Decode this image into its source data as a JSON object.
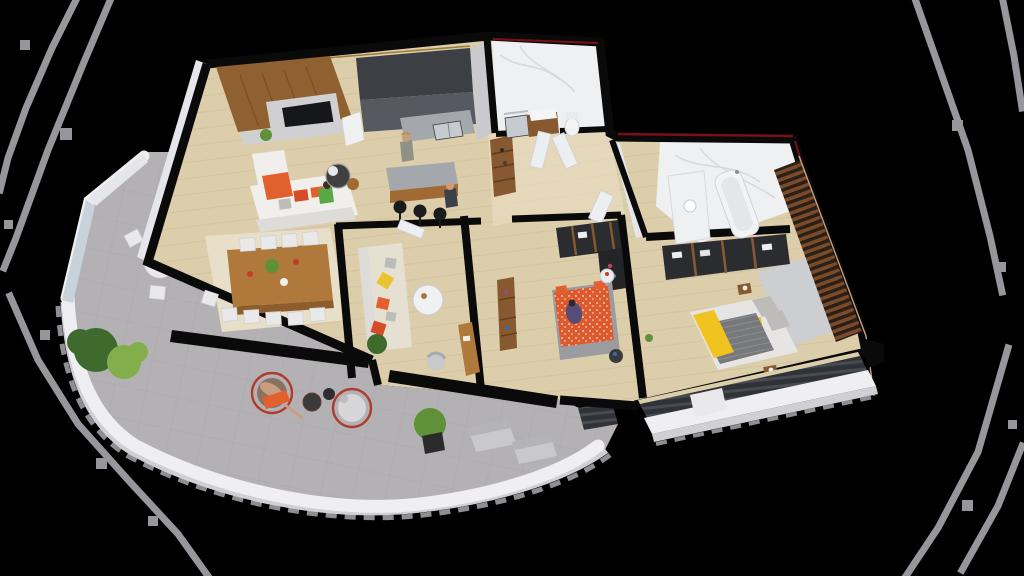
{
  "scene": {
    "type": "isometric-3d-apartment-floor-plan-render",
    "rooms": [
      "living-room",
      "kitchen",
      "dining-area",
      "lounge",
      "hallway",
      "bathroom",
      "bedroom",
      "master-bedroom",
      "ensuite-bathroom",
      "terrace",
      "west-balcony",
      "master-balcony"
    ]
  },
  "palette": {
    "background": "#000000",
    "decor-line": "#97979b",
    "jag-gray": "#8f8f93",
    "wall-top": "#0a0a0b",
    "wall-face": "#e5e6e9",
    "wood-floor": "#dccdab",
    "wood-line": "#ccb992",
    "wood-light": "#e7dcc0",
    "marble": "#eef0f2",
    "marble-vein": "#d5d9dd",
    "concrete": "#b3b1b4",
    "tile-line": "#a3a1a4",
    "parapet": "#efeff1",
    "parapet-side": "#cfcfd4",
    "glass": "#c8d2da",
    "tv-wood": "#8f6130",
    "tv-screen": "#15171b",
    "tv-marble": "#d0d0d3",
    "kitchen-dark": "#3c3f44",
    "kitchen-mid": "#565a60",
    "counter": "#a4a8ad",
    "sink": "#c7cbcf",
    "island-wood": "#a26a33",
    "stool-black": "#1a1b1d",
    "table-wood": "#b0793c",
    "table-side": "#8d5e2b",
    "chair-white": "#e9e9ea",
    "rug": "#e8dfc9",
    "rug-gray": "#cdced1",
    "sofa-white": "#f0efec",
    "sofa-shade": "#dddcd8",
    "sofa-beige": "#e6e0d2",
    "cushion-orange": "#e2602e",
    "cushion-red": "#d84b27",
    "cushion-yellow": "#eac32e",
    "pillow-gray": "#bdbcb9",
    "bed-gray": "#9a9ca0",
    "bed-white": "#e6e5e4",
    "duvet-orange": "#dc5a2d",
    "throw-yellow": "#f0c31e",
    "blanket-gray": "#76787c",
    "wardrobe-dark": "#2a2c2f",
    "wardrobe-wood": "#885930",
    "slat-wood": "#7c4a27",
    "slat-dark": "#2b2017",
    "railing-dark": "#2f3338",
    "railing-stripe": "#484c52",
    "plant-dark": "#3e6a2d",
    "plant-mid": "#5f9139",
    "plant-light": "#82ae4b",
    "pot-dark": "#2b2b2d",
    "chair-red": "#b03a2e",
    "chair-pad": "#8a7260",
    "skin": "#c99d7d",
    "hair-blonde": "#c19256",
    "person-green": "#5aa748",
    "person-purple": "#564c77",
    "person-gray": "#d6d6d9",
    "person-dark": "#3c4147",
    "accent-red": "#7a1016",
    "edge-highlight": "#c9a084",
    "gold-trim": "#9c7b35",
    "door-white": "#eceff1",
    "bench-gray": "#c9c9cc",
    "bench-back": "#b4b4b8"
  }
}
